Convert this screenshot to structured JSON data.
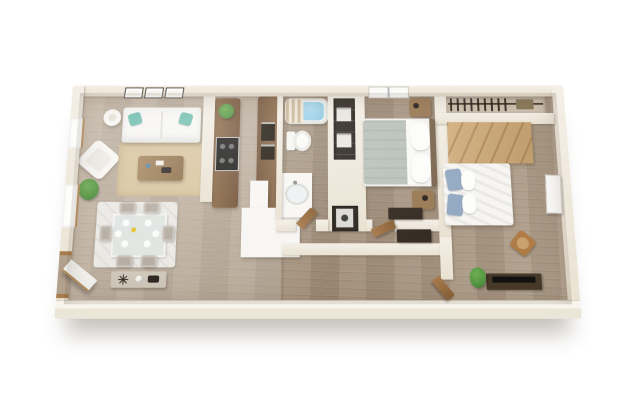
{
  "scene": {
    "kind": "3D apartment floor plan rendering, top-down perspective view",
    "background_color": "#ffffff"
  },
  "palette": {
    "wall": "#f4efe6",
    "wall_face": "#e9e2d2",
    "floor": "#b2a18d",
    "floor_light": "#c6b8a6",
    "cabinet_wood": "#8d6b49",
    "cabinet_wood_dark": "#74543a",
    "closet_wood": "#c9a87a",
    "door_wood": "#a87c4f",
    "rug_tan": "#d9c6a1",
    "rug_white": "#ebe9e4",
    "white_furniture": "#f7f6f3",
    "pillow_teal": "#73bfb1",
    "pillow_blue": "#94aac3",
    "blanket_gray": "#bac1bb",
    "seat_gray": "#b6aea3",
    "water_blue": "#8cc6e2",
    "dark_shelf": "#2e2822",
    "dark_furniture": "#362d24",
    "plant_green": "#4f9140",
    "chair_rattan": "#b07c46",
    "stove_black": "#1e1d1b"
  },
  "rooms": {
    "living": {
      "label": "Living room",
      "items": [
        "three wall frames",
        "round side table",
        "white sofa with teal pillows",
        "white accent chair",
        "wood coffee table",
        "tan area rug",
        "floor plant",
        "two windows"
      ]
    },
    "dining": {
      "label": "Dining area",
      "items": [
        "glass dining table",
        "six gray chairs",
        "white area rug",
        "console table with decor",
        "open entry door"
      ]
    },
    "kitchen": {
      "label": "Galley kitchen",
      "items": [
        "wood counter with stove",
        "small plant",
        "tall wood cabinets",
        "white peninsula counter"
      ]
    },
    "bathroom": {
      "label": "Bathroom",
      "items": [
        "bathtub with water",
        "striped shower curtain",
        "toilet",
        "vanity with sink",
        "open wood door"
      ]
    },
    "storage": {
      "label": "Storage closets",
      "items": [
        "dark shelving with boxes",
        "laundry niche with appliance"
      ]
    },
    "bedroom1": {
      "label": "Bedroom 1",
      "items": [
        "window",
        "bed with gray blanket",
        "two wood nightstands",
        "dark dresser",
        "open wood door"
      ]
    },
    "bedroom2": {
      "label": "Bedroom 2",
      "items": [
        "closet with hanging rod",
        "light wood panel floor",
        "bed with blue pillows",
        "wall art",
        "rattan chair",
        "dark media console",
        "potted plant",
        "open wood door"
      ]
    },
    "hallway": {
      "label": "Hallway",
      "items": [
        "dark console table"
      ]
    }
  },
  "counts": {
    "bedrooms": 2,
    "bathrooms": 1,
    "dining_chairs": 6,
    "wall_frames": 3,
    "windows_left_wall": 2,
    "open_doors": 4
  }
}
